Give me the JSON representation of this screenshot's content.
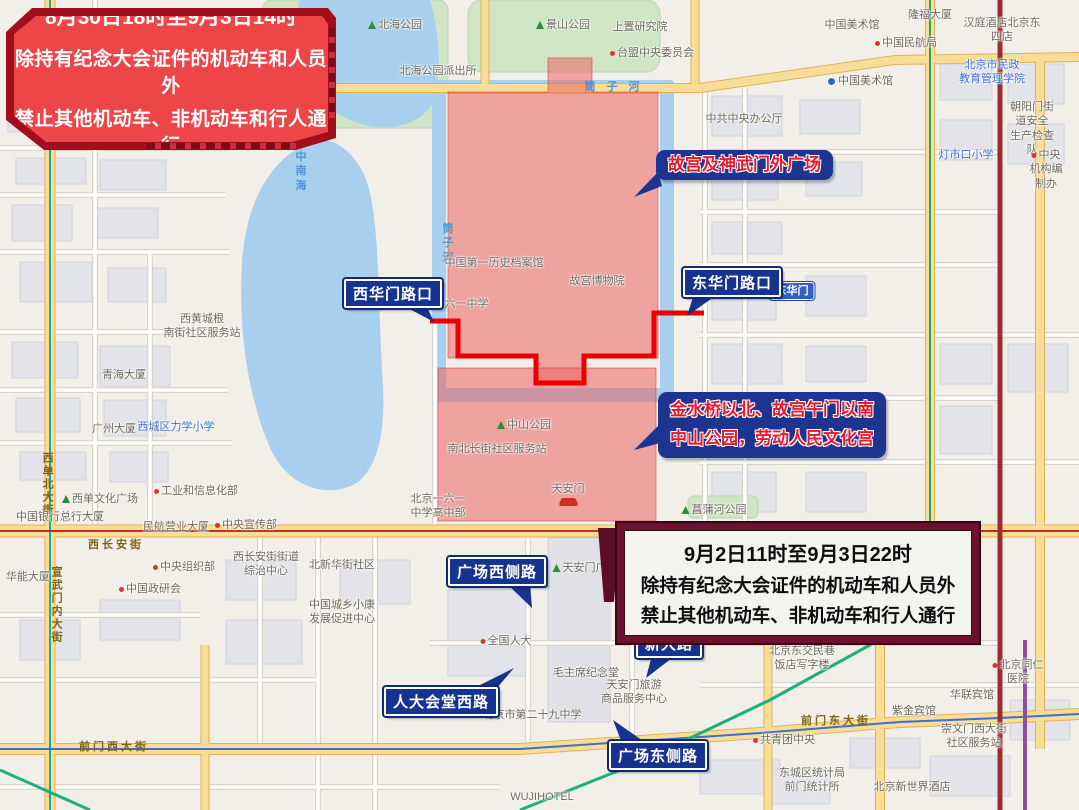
{
  "banners": {
    "northwest": {
      "line1": "8月30日18时至9月3日14时",
      "line2": "除持有纪念大会证件的机动车和人员外",
      "line3": "禁止其他机动车、非机动车和行人通行"
    },
    "southeast": {
      "line1": "9月2日11时至9月3日22时",
      "line2": "除持有纪念大会证件的机动车和人员外",
      "line3": "禁止其他机动车、非机动车和行人通行"
    }
  },
  "zone_labels": {
    "palace": "故宫及神武门外广场",
    "jinshui": "金水桥以北、故宫午门以南\n中山公园，劳动人民文化宫"
  },
  "road_callouts": [
    {
      "id": "xihuamen",
      "label": "西华门路口"
    },
    {
      "id": "donghuamen",
      "label": "东华门路口"
    },
    {
      "id": "gc-west",
      "label": "广场西侧路"
    },
    {
      "id": "xindalu",
      "label": "新大路"
    },
    {
      "id": "renda-west",
      "label": "人大会堂西路"
    },
    {
      "id": "gc-east",
      "label": "广场东侧路"
    }
  ],
  "map_labels": [
    {
      "text": "北海公园",
      "x": 395,
      "y": 18,
      "type": "park"
    },
    {
      "text": "景山公园",
      "x": 563,
      "y": 18,
      "type": "park"
    },
    {
      "text": "北海公园派出所",
      "x": 438,
      "y": 64,
      "type": "poi"
    },
    {
      "text": "上置研究院",
      "x": 640,
      "y": 20,
      "type": "poi"
    },
    {
      "text": "台盟中央委员会",
      "x": 652,
      "y": 46,
      "type": "poi-red"
    },
    {
      "text": "中国美术馆",
      "x": 852,
      "y": 18,
      "type": "poi"
    },
    {
      "text": "隆福大厦",
      "x": 930,
      "y": 8,
      "type": "poi"
    },
    {
      "text": "汉庭酒店北京东四店",
      "x": 1002,
      "y": 16,
      "type": "poi"
    },
    {
      "text": "中国民航局",
      "x": 906,
      "y": 36,
      "type": "poi-red"
    },
    {
      "text": "中国美术馆",
      "x": 860,
      "y": 74,
      "type": "metro"
    },
    {
      "text": "北京市民政\n教育管理学院",
      "x": 992,
      "y": 58,
      "type": "blue"
    },
    {
      "text": "朝阳门街道安全\n生产检查队",
      "x": 1032,
      "y": 100,
      "type": "poi"
    },
    {
      "text": "灯市口小学",
      "x": 966,
      "y": 148,
      "type": "blue"
    },
    {
      "text": "中央机构编制办",
      "x": 1046,
      "y": 148,
      "type": "poi-red"
    },
    {
      "text": "中共中央办公厅",
      "x": 744,
      "y": 112,
      "type": "poi"
    },
    {
      "text": "筒 子 河",
      "x": 614,
      "y": 80,
      "type": "water"
    },
    {
      "text": "筒\n子\n河",
      "x": 450,
      "y": 222,
      "type": "water"
    },
    {
      "text": "中\n南\n海",
      "x": 303,
      "y": 150,
      "type": "water"
    },
    {
      "text": "故宫博物院",
      "x": 597,
      "y": 274,
      "type": "poi"
    },
    {
      "text": "中国第一历史档案馆",
      "x": 494,
      "y": 256,
      "type": "poi"
    },
    {
      "text": "北京一六一中学",
      "x": 450,
      "y": 297,
      "type": "poi"
    },
    {
      "text": "东华门",
      "x": 792,
      "y": 282,
      "type": "sign"
    },
    {
      "text": "中山公园",
      "x": 524,
      "y": 418,
      "type": "park"
    },
    {
      "text": "南北长街社区服务站",
      "x": 497,
      "y": 442,
      "type": "poi"
    },
    {
      "text": "天安门",
      "x": 568,
      "y": 482,
      "type": "gate"
    },
    {
      "text": "北京一六一\n中学高中部",
      "x": 438,
      "y": 492,
      "type": "poi"
    },
    {
      "text": "菖蒲河公园",
      "x": 714,
      "y": 503,
      "type": "park"
    },
    {
      "text": "西黄城根\n南街社区服务站",
      "x": 202,
      "y": 312,
      "type": "poi"
    },
    {
      "text": "青海大厦",
      "x": 124,
      "y": 368,
      "type": "poi"
    },
    {
      "text": "广州大厦",
      "x": 114,
      "y": 422,
      "type": "poi"
    },
    {
      "text": "西城区力学小学",
      "x": 176,
      "y": 420,
      "type": "blue"
    },
    {
      "text": "工业和信息化部",
      "x": 196,
      "y": 484,
      "type": "poi-red"
    },
    {
      "text": "西单文化广场",
      "x": 100,
      "y": 492,
      "type": "park"
    },
    {
      "text": "西单北大街",
      "x": 47,
      "y": 452,
      "type": "road-v"
    },
    {
      "text": "宣武门内大街",
      "x": 56,
      "y": 566,
      "type": "road-v"
    },
    {
      "text": "中国银行总行大厦",
      "x": 60,
      "y": 510,
      "type": "poi"
    },
    {
      "text": "民航营业大厦",
      "x": 176,
      "y": 520,
      "type": "poi"
    },
    {
      "text": "中央宣传部",
      "x": 246,
      "y": 518,
      "type": "poi-red"
    },
    {
      "text": "西长安街",
      "x": 116,
      "y": 538,
      "type": "road"
    },
    {
      "text": "中央组织部",
      "x": 184,
      "y": 560,
      "type": "poi-red"
    },
    {
      "text": "西长安街街道\n综治中心",
      "x": 266,
      "y": 550,
      "type": "poi"
    },
    {
      "text": "北新华街社区",
      "x": 342,
      "y": 558,
      "type": "poi"
    },
    {
      "text": "中国政研会",
      "x": 150,
      "y": 582,
      "type": "poi-red"
    },
    {
      "text": "华能大厦",
      "x": 28,
      "y": 570,
      "type": "poi"
    },
    {
      "text": "中国城乡小康\n发展促进中心",
      "x": 342,
      "y": 598,
      "type": "poi"
    },
    {
      "text": "天安门广场",
      "x": 585,
      "y": 561,
      "type": "park"
    },
    {
      "text": "全国人大",
      "x": 506,
      "y": 634,
      "type": "poi-red"
    },
    {
      "text": "毛主席纪念堂",
      "x": 586,
      "y": 666,
      "type": "poi"
    },
    {
      "text": "天安门旅游\n商品服务中心",
      "x": 634,
      "y": 678,
      "type": "poi"
    },
    {
      "text": "北京市第二十九中学",
      "x": 532,
      "y": 708,
      "type": "poi"
    },
    {
      "text": "前门西大街",
      "x": 114,
      "y": 740,
      "type": "road"
    },
    {
      "text": "前门东大街",
      "x": 836,
      "y": 714,
      "type": "road"
    },
    {
      "text": "共青团中央",
      "x": 784,
      "y": 733,
      "type": "poi-red"
    },
    {
      "text": "北京东交民巷\n饭店写字楼",
      "x": 802,
      "y": 644,
      "type": "poi"
    },
    {
      "text": "北京同仁医院",
      "x": 1018,
      "y": 658,
      "type": "poi-red"
    },
    {
      "text": "华联宾馆",
      "x": 972,
      "y": 688,
      "type": "poi"
    },
    {
      "text": "紫金宾馆",
      "x": 914,
      "y": 704,
      "type": "poi"
    },
    {
      "text": "崇文门西大街\n社区服务站",
      "x": 974,
      "y": 722,
      "type": "poi"
    },
    {
      "text": "北京新世界酒店",
      "x": 912,
      "y": 780,
      "type": "poi"
    },
    {
      "text": "东城区统计局\n前门统计所",
      "x": 812,
      "y": 766,
      "type": "poi"
    },
    {
      "text": "WUJIHOTEL",
      "x": 542,
      "y": 790,
      "type": "poi"
    }
  ],
  "colors": {
    "banner_red": "#ee4549",
    "banner_frame": "#a30e1d",
    "banner2_border": "#6d1130",
    "callout_blue": "#16338f",
    "zone_label_blue": "#1d3490",
    "zone_label_text_red": "#e8192c",
    "restricted_zone_pink": "rgba(236,93,93,0.52)",
    "restriction_line_red": "#ea0000",
    "water_blue": "#a9cfee",
    "park_green": "#cfe5c6",
    "road_yellow": "#f7dd96"
  }
}
